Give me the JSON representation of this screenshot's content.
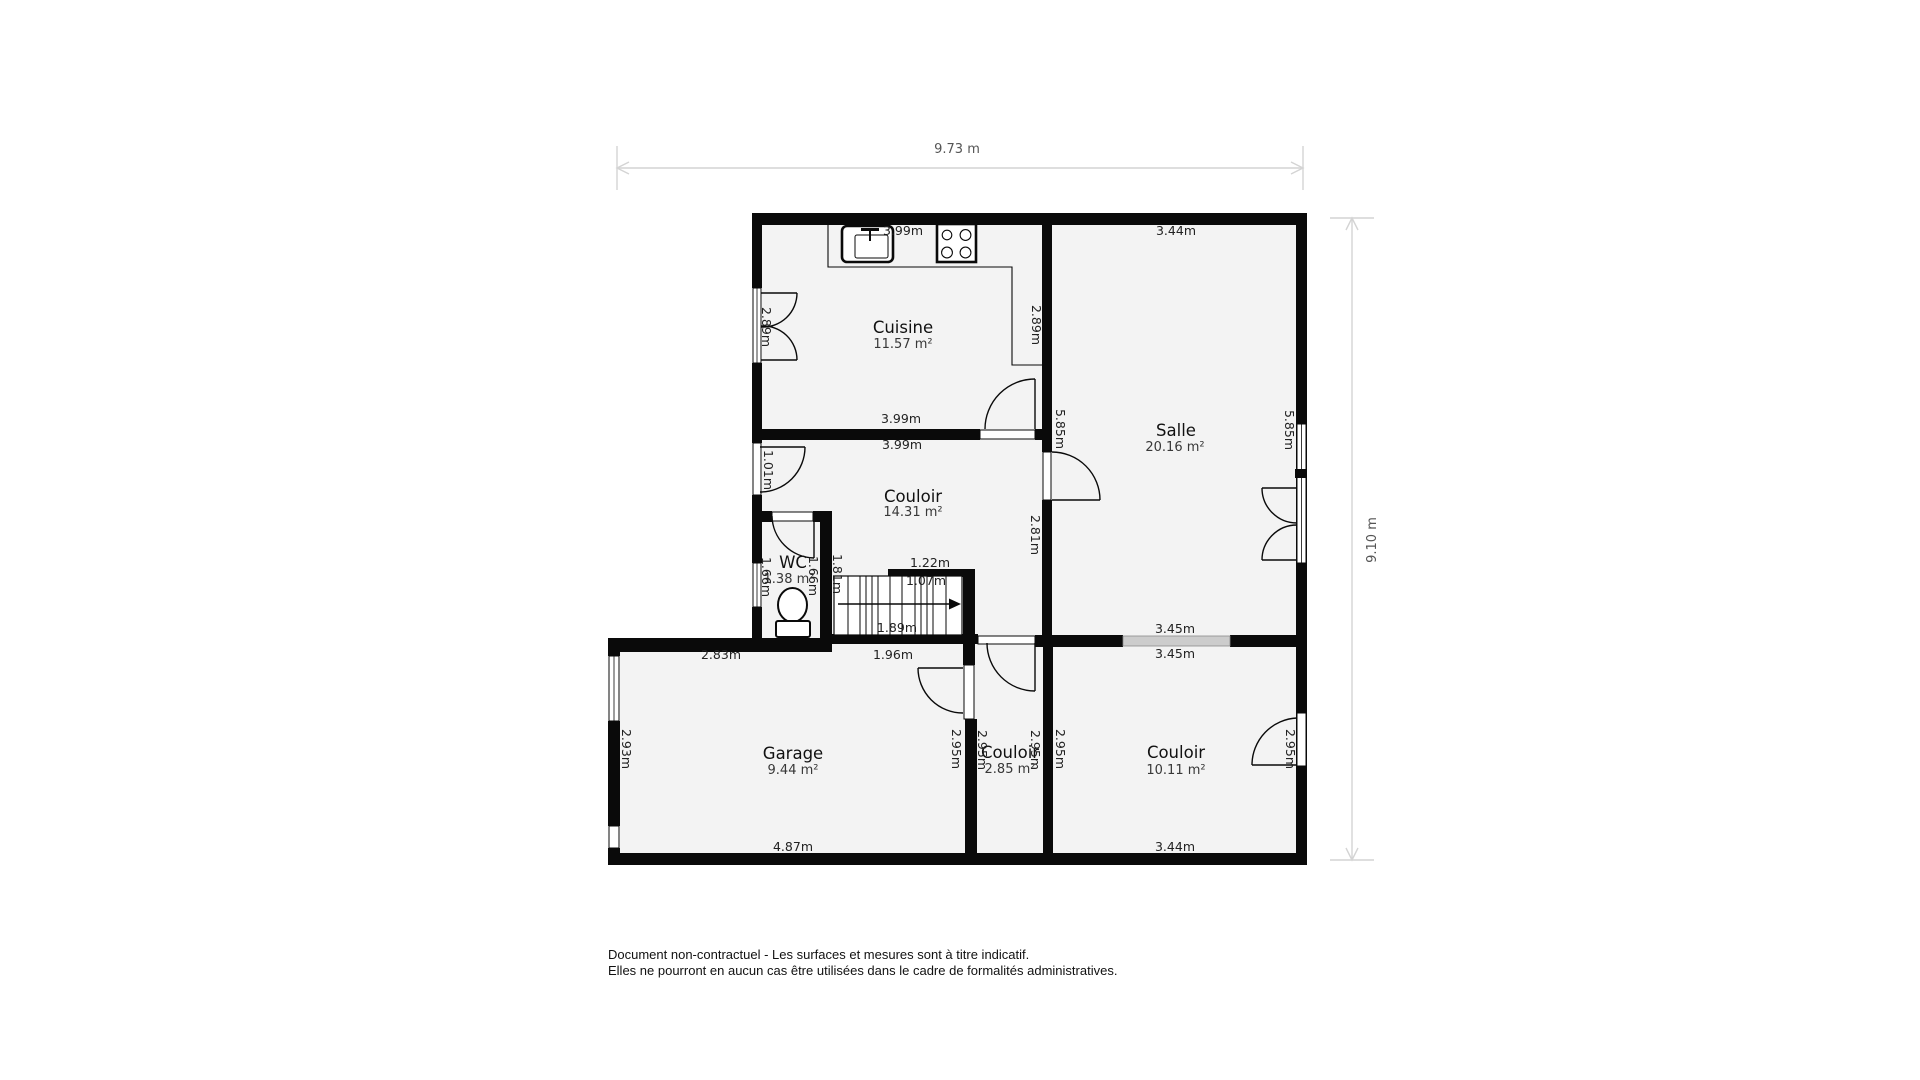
{
  "plan": {
    "overall": {
      "width_label": "9.73 m",
      "height_label": "9.10 m"
    },
    "rooms": {
      "cuisine": {
        "name": "Cuisine",
        "area": "11.57 m²",
        "dim_top": "3.99m",
        "dim_bottom": "3.99m",
        "dim_left": "2.89m",
        "dim_right": "2.89m"
      },
      "salle": {
        "name": "Salle",
        "area": "20.16 m²",
        "dim_top": "3.44m",
        "dim_bottom": "3.45m",
        "dim_left": "5.85m",
        "dim_right": "5.85m"
      },
      "couloir_centre": {
        "name": "Couloir",
        "area": "14.31 m²",
        "dim_top": "3.99m",
        "dim_left": "1.01m",
        "dim_right": "2.81m",
        "dim_edge": "1.81m"
      },
      "wc": {
        "name": "WC",
        "area": "1.38 m²",
        "dim_left": "1.66m",
        "dim_right": "1.66m"
      },
      "escalier": {
        "dim_top": "1.22m",
        "dim_length": "1.07m",
        "dim_bottom": "1.89m"
      },
      "garage": {
        "name": "Garage",
        "area": "9.44 m²",
        "dim_top_left": "2.83m",
        "dim_top_right": "1.96m",
        "dim_bottom": "4.87m",
        "dim_left": "2.93m",
        "dim_right": "2.95m"
      },
      "petit_couloir": {
        "name": "Couloir",
        "area": "2.85 m²",
        "dim_left": "2.95m",
        "dim_right": "2.95m"
      },
      "couloir_entree": {
        "name": "Couloir",
        "area": "10.11 m²",
        "dim_top": "3.45m",
        "dim_bottom": "3.44m",
        "dim_left": "2.95m",
        "dim_right": "2.95m"
      }
    },
    "disclaimer": [
      "Document non-contractuel - Les surfaces et mesures sont à titre indicatif.",
      "Elles ne pourront en aucun cas être utilisées dans le cadre de formalités administratives."
    ],
    "colors": {
      "wall": "#0a0a0a",
      "floor": "#f3f3f3",
      "dimension_line": "#d4d4d4",
      "window_glass": "#cccccc",
      "room_name_text": "#111111",
      "area_text": "#383838",
      "dimension_text": "#222222"
    }
  }
}
